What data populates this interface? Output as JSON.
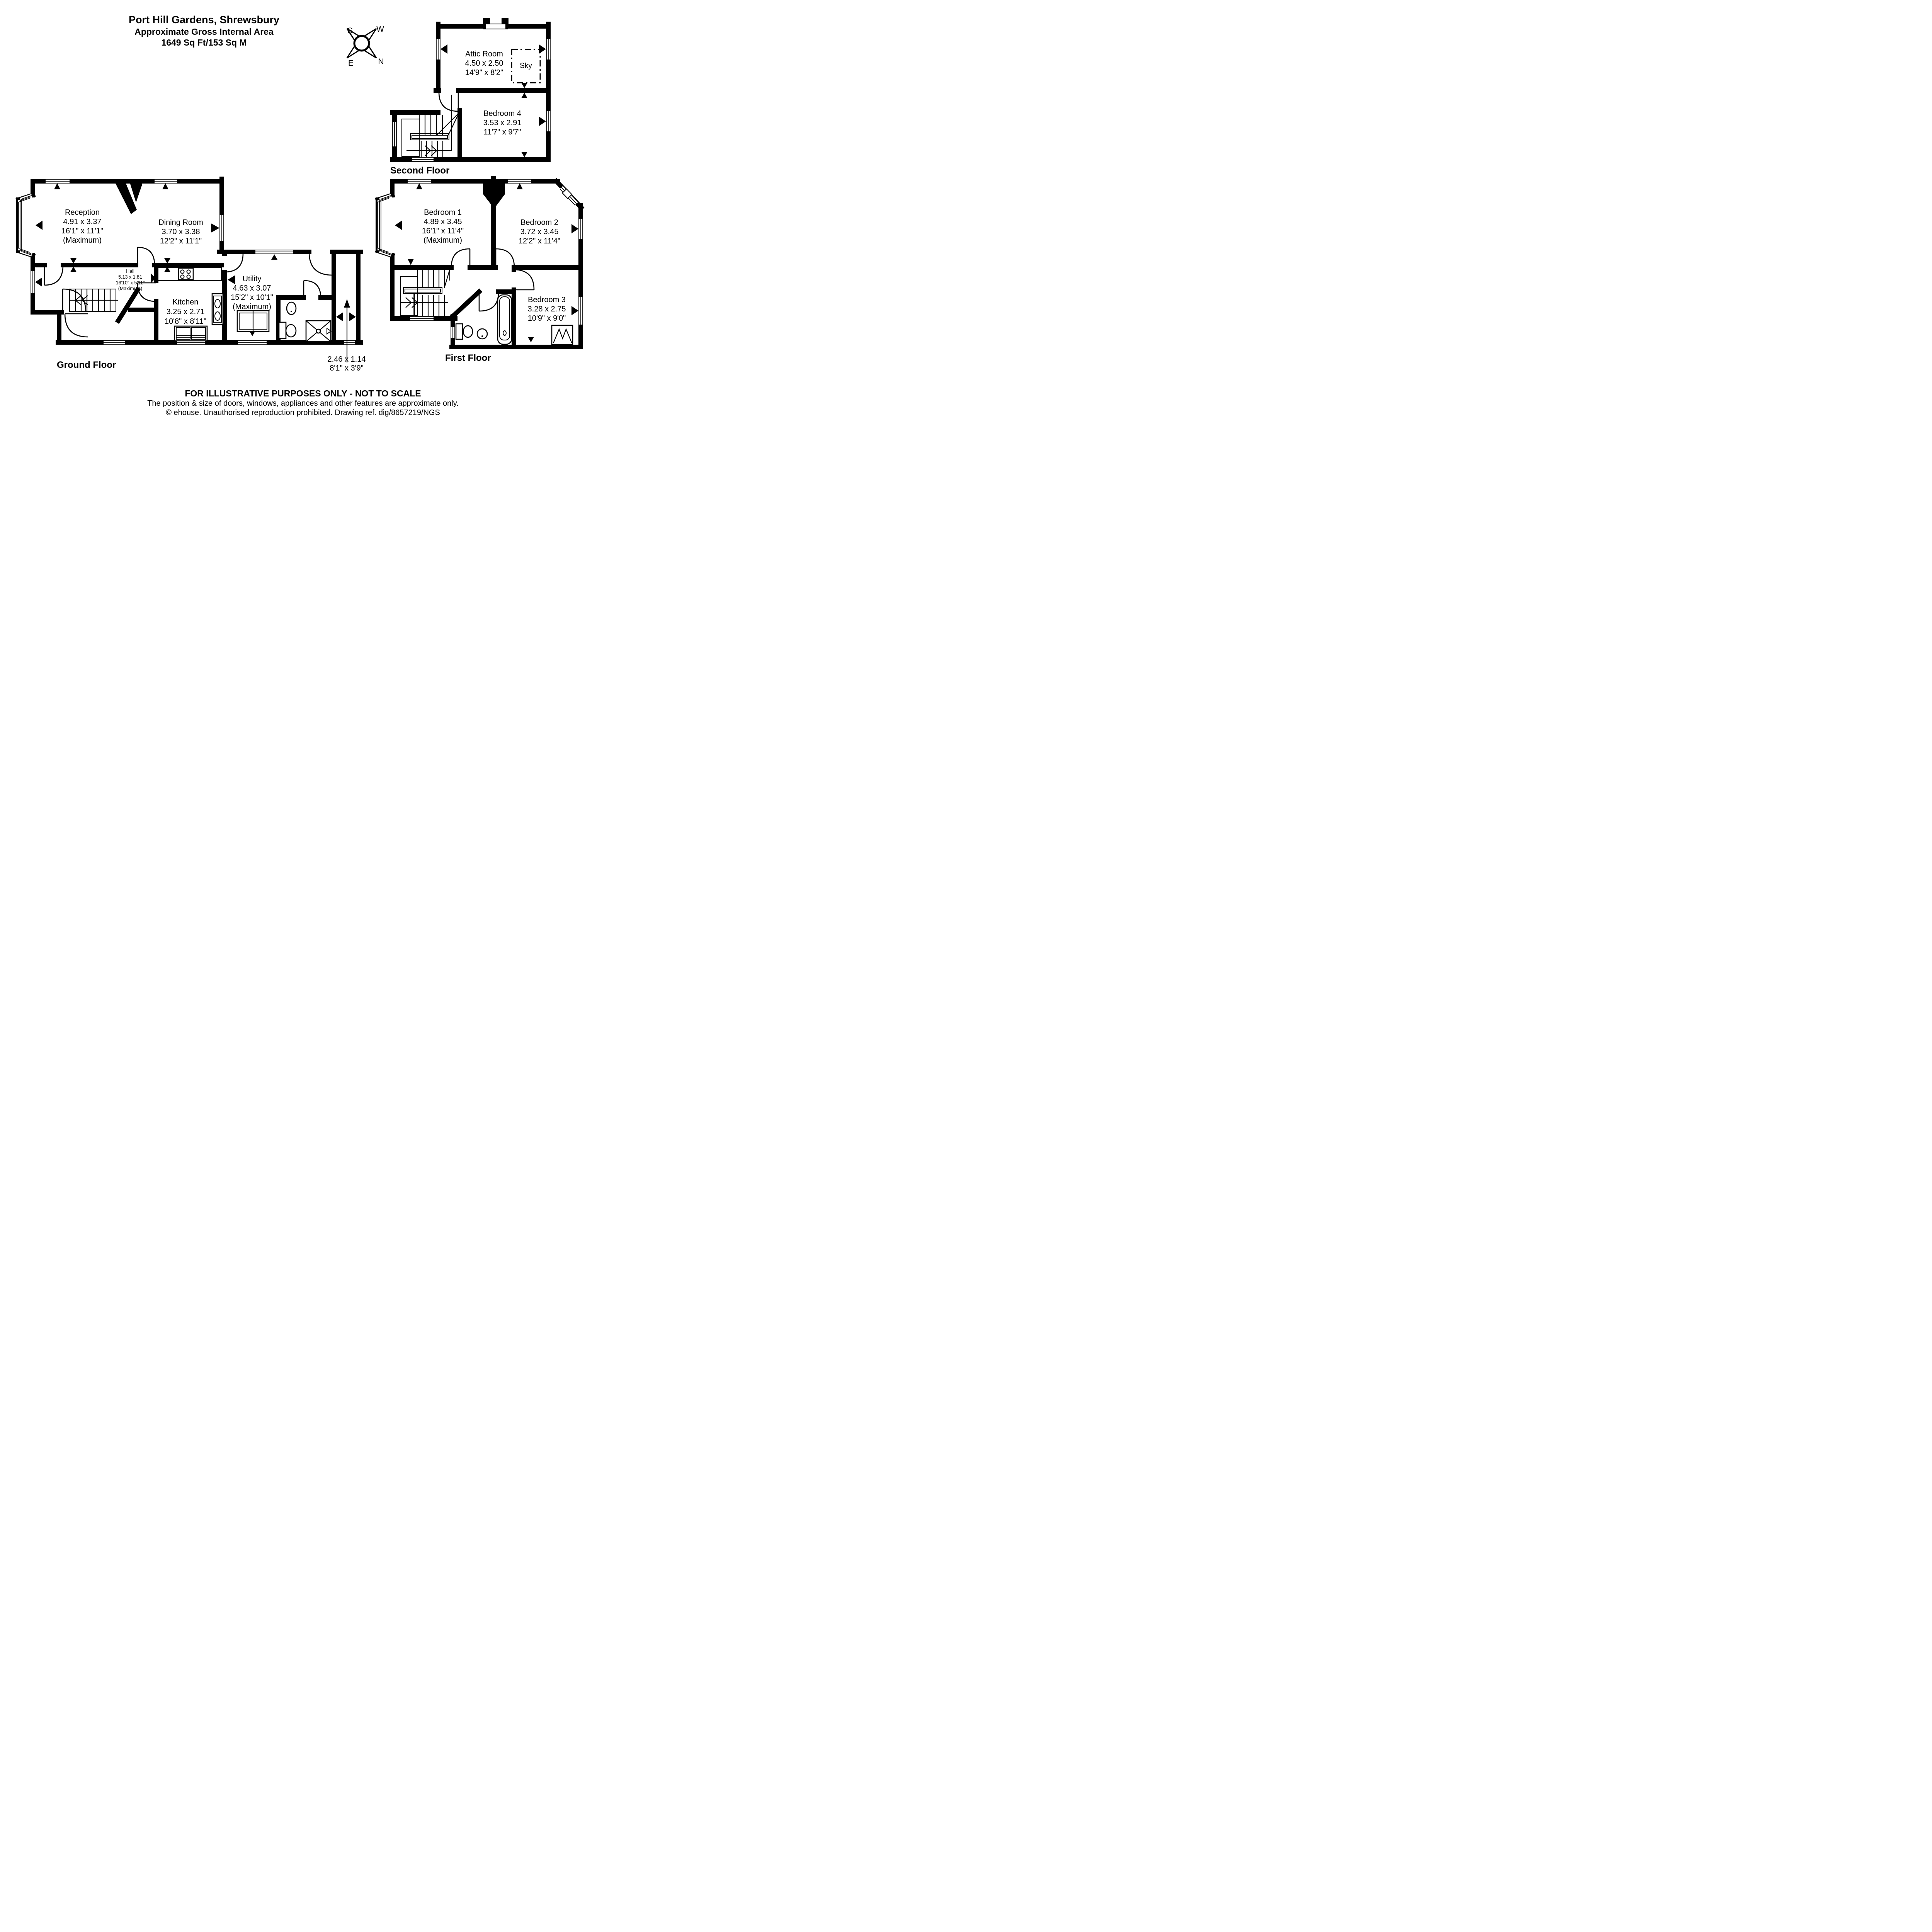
{
  "header": {
    "title": "Port Hill Gardens, Shrewsbury",
    "subtitle": "Approximate Gross Internal Area",
    "area": "1649 Sq Ft/153 Sq M"
  },
  "compass": {
    "n": "N",
    "s": "S",
    "e": "E",
    "w": "W"
  },
  "floors": {
    "second": {
      "label": "Second Floor",
      "sky_label": "Sky",
      "rooms": {
        "attic": {
          "name": "Attic Room",
          "metric": "4.50 x 2.50",
          "imperial": "14'9\" x 8'2\""
        },
        "bedroom4": {
          "name": "Bedroom 4",
          "metric": "3.53 x 2.91",
          "imperial": "11'7\" x 9'7\""
        }
      }
    },
    "ground": {
      "label": "Ground Floor",
      "rooms": {
        "reception": {
          "name": "Reception",
          "metric": "4.91 x 3.37",
          "imperial": "16'1\" x 11'1\"",
          "note": "(Maximum)"
        },
        "dining": {
          "name": "Dining Room",
          "metric": "3.70 x 3.38",
          "imperial": "12'2\" x 11'1\""
        },
        "hall": {
          "name": "Hall",
          "metric": "5.13 x 1.81",
          "imperial": "16'10\" x 5'11\"",
          "note": "(Maximum)"
        },
        "kitchen": {
          "name": "Kitchen",
          "metric": "3.25 x 2.71",
          "imperial": "10'8\" x 8'11\""
        },
        "utility": {
          "name": "Utility",
          "metric": "4.63 x 3.07",
          "imperial": "15'2\" x 10'1\"",
          "note": "(Maximum)"
        }
      },
      "passage": {
        "metric": "2.46 x 1.14",
        "imperial": "8'1\" x 3'9\""
      }
    },
    "first": {
      "label": "First Floor",
      "rooms": {
        "bedroom1": {
          "name": "Bedroom 1",
          "metric": "4.89 x 3.45",
          "imperial": "16'1\" x 11'4\"",
          "note": "(Maximum)"
        },
        "bedroom2": {
          "name": "Bedroom 2",
          "metric": "3.72 x 3.45",
          "imperial": "12'2\" x 11'4\""
        },
        "bedroom3": {
          "name": "Bedroom 3",
          "metric": "3.28 x 2.75",
          "imperial": "10'9\" x 9'0\""
        }
      }
    }
  },
  "footer": {
    "line1": "FOR ILLUSTRATIVE PURPOSES ONLY - NOT TO SCALE",
    "line2": "The position & size of doors, windows, appliances and other features are approximate only.",
    "line3": "© ehouse. Unauthorised reproduction prohibited. Drawing ref. dig/8657219/NGS"
  },
  "colors": {
    "ink": "#000000",
    "paper": "#ffffff"
  }
}
